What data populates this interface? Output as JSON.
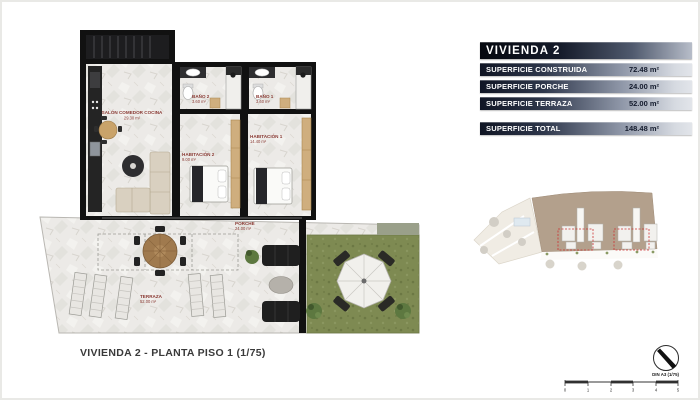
{
  "summary_table": {
    "title": "VIVIENDA 2",
    "rows": [
      {
        "label": "SUPERFICIE CONSTRUIDA",
        "value": "72.48 m²"
      },
      {
        "label": "SUPERFICIE PORCHE",
        "value": "24.00 m²"
      },
      {
        "label": "SUPERFICIE TERRAZA",
        "value": "52.00 m²"
      }
    ],
    "total_row": {
      "label": "SUPERFICIE TOTAL",
      "value": "148.48 m²"
    }
  },
  "plan": {
    "rooms": [
      {
        "name": "SALÓN COMEDOR COCINA",
        "area": "29.30 m²"
      },
      {
        "name": "BAÑO 2",
        "area": "3.60 m²"
      },
      {
        "name": "BAÑO 1",
        "area": "3.60 m²"
      },
      {
        "name": "HABITACIÓN 2",
        "area": "9.00 m²"
      },
      {
        "name": "HABITACIÓN 1",
        "area": "14.40 m²"
      },
      {
        "name": "PORCHE",
        "area": "24.00 m²"
      },
      {
        "name": "TERRAZA",
        "area": "52.00 m²"
      }
    ]
  },
  "caption": "VIVIENDA 2 - PLANTA PISO 1 (1/75)",
  "scale_bar": {
    "din_label": "DIN A3 (1/75)",
    "ticks": [
      "0",
      "1",
      "2",
      "3",
      "4",
      "5"
    ]
  },
  "colors": {
    "accent_dark": "#101524",
    "accent_silver": "#e2e5ea",
    "room_label": "#8a3a34",
    "grass": "#7e8a52",
    "highlight_red": "#cc3333"
  }
}
